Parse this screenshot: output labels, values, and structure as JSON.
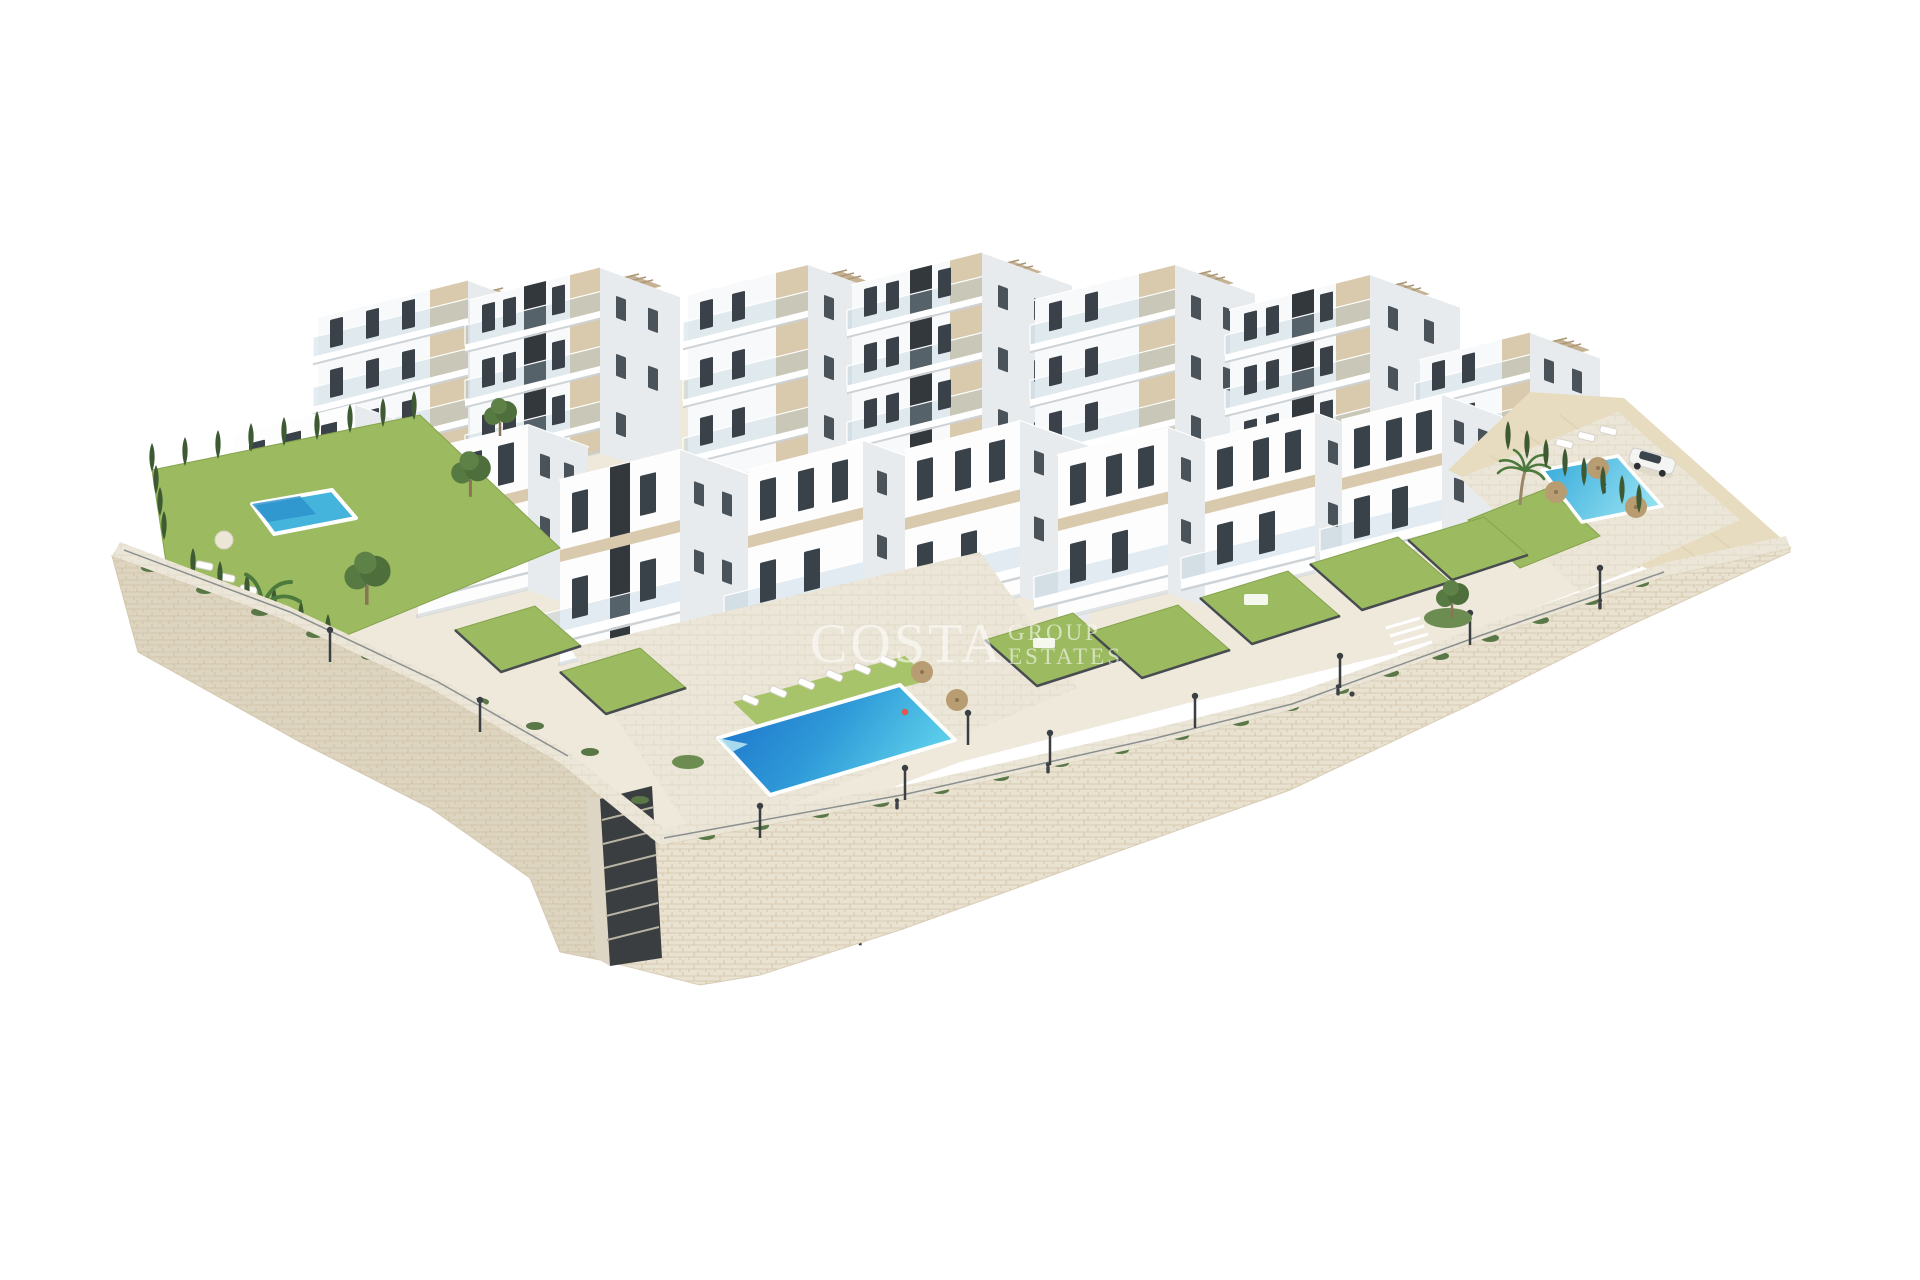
{
  "meta": {
    "alt": "Aerial 3D architectural render of a white modern apartment complex built on terraced land with beige stone retaining walls, private lawned gardens, a large communal swimming pool, two smaller pools, palm trees, cypress hedges, a promenade with street lamps and a parked white car, on a plain white background."
  },
  "watermark": {
    "brand_line1": "COSTA",
    "brand_line2": "GROUP",
    "brand_line3": "ESTATES"
  },
  "palette": {
    "background": "#ffffff",
    "building_white": "#f8f9fa",
    "building_side": "#e8ebed",
    "accent_beige": "#d9c9ad",
    "window_dark": "#3a4148",
    "stair_core_dark": "#33383d",
    "stone_wall": "#eae2d1",
    "stone_joint": "#d7cbb2",
    "paving": "#ece6d8",
    "lawn_green": "#9cba5f",
    "hedge_green": "#3d5a33",
    "pool_deep_blue": "#1b6fc9",
    "pool_mid_blue": "#2f9ad8",
    "pool_light_cyan": "#5bcdea",
    "sand_bank": "#e8dcc0",
    "pergola_tan": "#c6b293"
  },
  "scene": {
    "features": [
      "stepped white apartment blocks with rooftop pergolas",
      "private gardens with bright lawns and dark fences",
      "large communal pool with sun loungers and parasols",
      "small garden pool on the left plot",
      "second communal pool with parasols on the right plot",
      "beige dry-stone retaining walls with stair channel",
      "pedestrian promenade with street lamps and people",
      "palm trees, leafy trees and cypress hedges",
      "white car parked on upper right terrace"
    ]
  }
}
